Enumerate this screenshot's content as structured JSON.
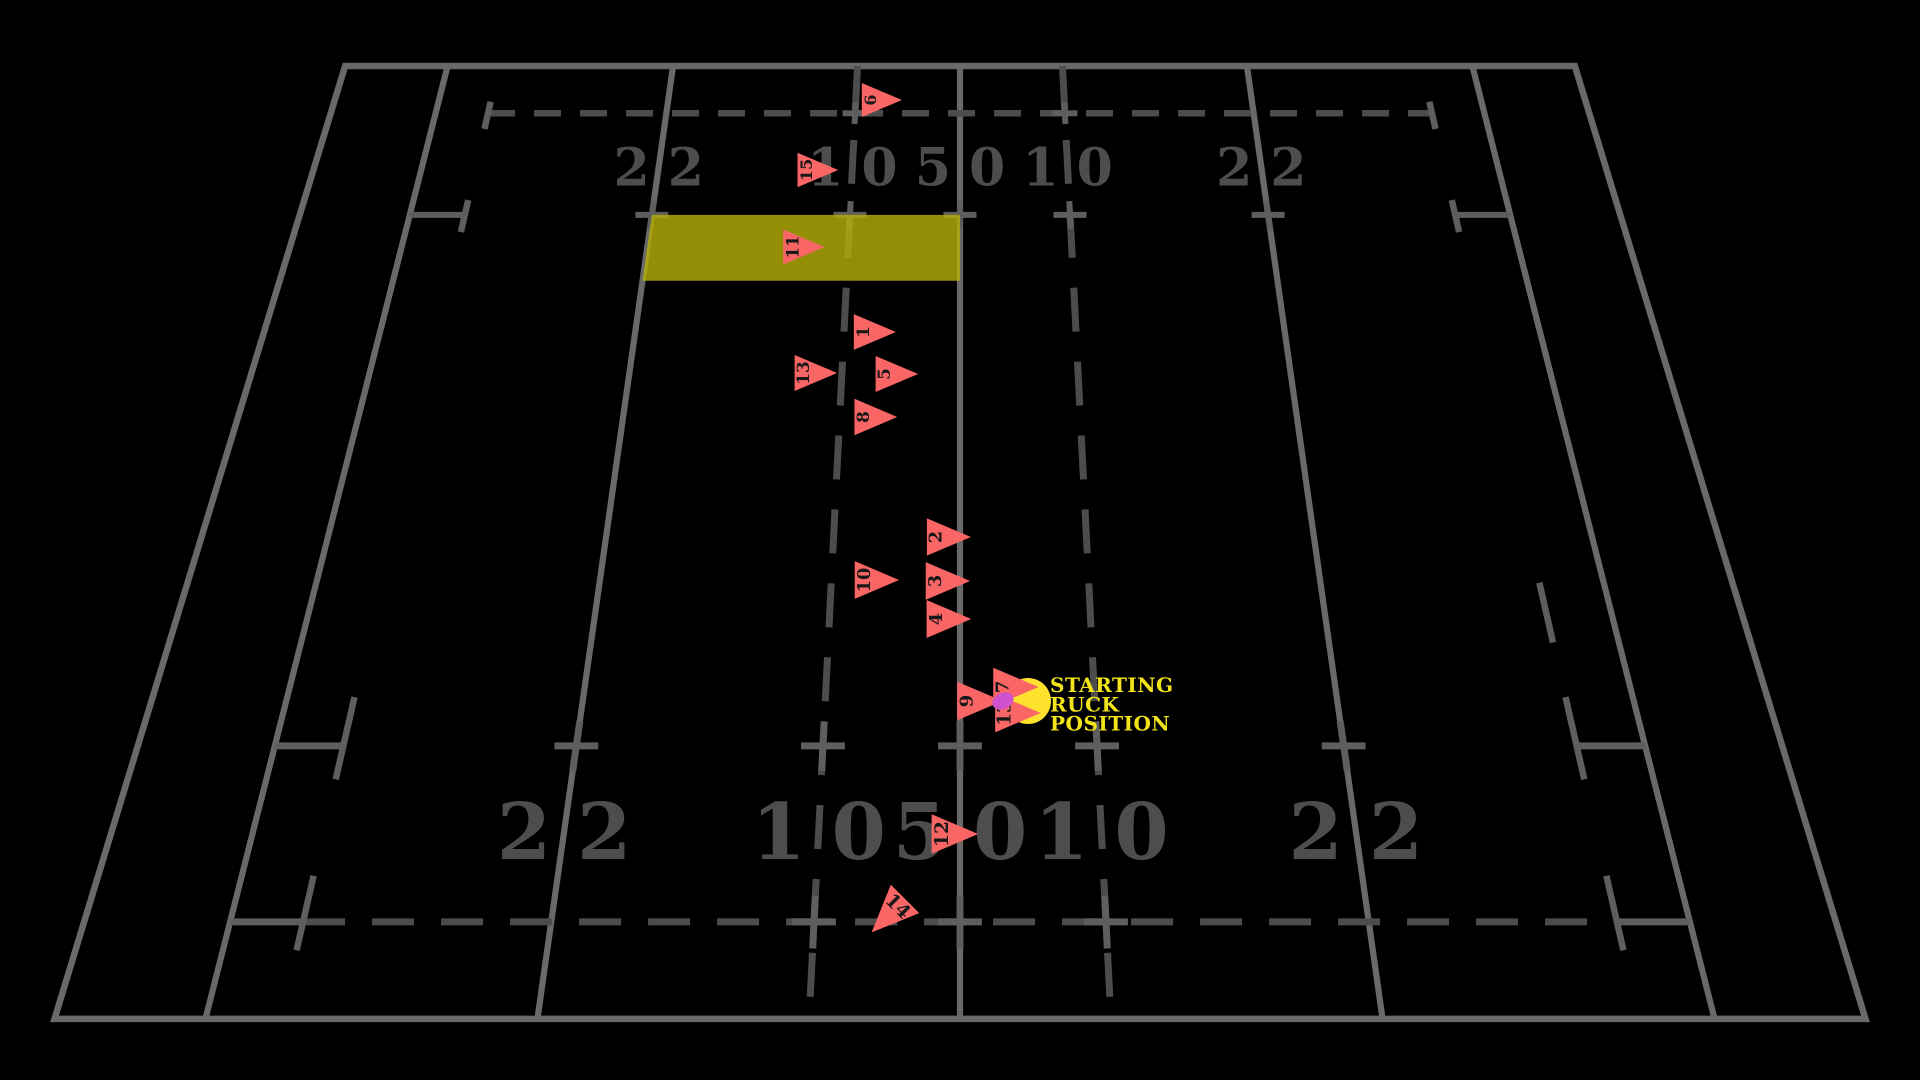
{
  "canvas": {
    "width": 1920,
    "height": 1080
  },
  "colors": {
    "background": "#000000",
    "solid_line": "#696969",
    "dashed_line": "#4c4c4c",
    "tick": "#5e5e5e",
    "field_label": "#4d4d4d",
    "marker_fill": "#fa6666",
    "marker_number": "#181818",
    "zone_fill": "#b5ad08",
    "annotation_yellow": "#f2e418",
    "ball_yellow": "#ffe22e",
    "magenta_dot": "#cf52cf"
  },
  "field": {
    "line_labels": [
      "22",
      "10",
      "50",
      "10",
      "22"
    ],
    "label_positions_m_from_halfway": [
      -28,
      -10,
      0,
      10,
      28
    ]
  },
  "annotation": {
    "lines": [
      "STARTING",
      "RUCK",
      "POSITION"
    ],
    "x": 1050,
    "y": 676
  },
  "ruck": {
    "ball_x": 1028,
    "ball_y": 701,
    "ball_r": 23,
    "dot_x": 1003,
    "dot_y": 701,
    "dot_rx": 11,
    "dot_ry": 8
  },
  "zone": {
    "u1": -28,
    "u2": 0,
    "v1": 15,
    "v2": 21
  },
  "chart_data": {
    "type": "scatter",
    "annotation": "STARTING RUCK POSITION",
    "x_axis": "field lines labelled 22 / 10 / 50 / 10 / 22 (metres)",
    "legend_position": "none",
    "players": [
      {
        "number": "6",
        "x_px": 881,
        "y_px": 100,
        "x_m_from_halfway": -7.6,
        "y_m_from_far_touchline": 3.5,
        "rotation_deg": 0
      },
      {
        "number": "15",
        "x_px": 817,
        "y_px": 170,
        "x_m_from_halfway": -13.3,
        "y_m_from_far_touchline": 10.5,
        "rotation_deg": 0
      },
      {
        "number": "11",
        "x_px": 803,
        "y_px": 247,
        "x_m_from_halfway": -14.1,
        "y_m_from_far_touchline": 17.7,
        "rotation_deg": 0
      },
      {
        "number": "1",
        "x_px": 874,
        "y_px": 332,
        "x_m_from_halfway": -7.4,
        "y_m_from_far_touchline": 25.1,
        "rotation_deg": 0
      },
      {
        "number": "13",
        "x_px": 815,
        "y_px": 373,
        "x_m_from_halfway": -12.3,
        "y_m_from_far_touchline": 28.4,
        "rotation_deg": 0
      },
      {
        "number": "5",
        "x_px": 896,
        "y_px": 374,
        "x_m_from_halfway": -5.4,
        "y_m_from_far_touchline": 28.5,
        "rotation_deg": 0
      },
      {
        "number": "8",
        "x_px": 875,
        "y_px": 417,
        "x_m_from_halfway": -7.1,
        "y_m_from_far_touchline": 31.9,
        "rotation_deg": 0
      },
      {
        "number": "2",
        "x_px": 948,
        "y_px": 537,
        "x_m_from_halfway": -0.9,
        "y_m_from_far_touchline": 40.8,
        "rotation_deg": 0
      },
      {
        "number": "10",
        "x_px": 876,
        "y_px": 580,
        "x_m_from_halfway": -6.5,
        "y_m_from_far_touchline": 43.8,
        "rotation_deg": 0
      },
      {
        "number": "3",
        "x_px": 947,
        "y_px": 581,
        "x_m_from_halfway": -1.0,
        "y_m_from_far_touchline": 43.8,
        "rotation_deg": 0
      },
      {
        "number": "4",
        "x_px": 948,
        "y_px": 619,
        "x_m_from_halfway": -0.9,
        "y_m_from_far_touchline": 46.4,
        "rotation_deg": 0
      },
      {
        "number": "7",
        "x_px": 1015,
        "y_px": 687,
        "x_m_from_halfway": 4.1,
        "y_m_from_far_touchline": 50.7,
        "rotation_deg": 0
      },
      {
        "number": "9",
        "x_px": 979,
        "y_px": 701,
        "x_m_from_halfway": 1.4,
        "y_m_from_far_touchline": 51.6,
        "rotation_deg": 0
      },
      {
        "number": "13",
        "x_px": 1017,
        "y_px": 713,
        "x_m_from_halfway": 4.2,
        "y_m_from_far_touchline": 52.3,
        "rotation_deg": 0
      },
      {
        "number": "12",
        "x_px": 954,
        "y_px": 834,
        "x_m_from_halfway": -0.4,
        "y_m_from_far_touchline": 59.5,
        "rotation_deg": 0
      },
      {
        "number": "14",
        "x_px": 889,
        "y_px": 915,
        "x_m_from_halfway": -4.9,
        "y_m_from_far_touchline": 63.9,
        "rotation_deg": 135
      }
    ]
  }
}
